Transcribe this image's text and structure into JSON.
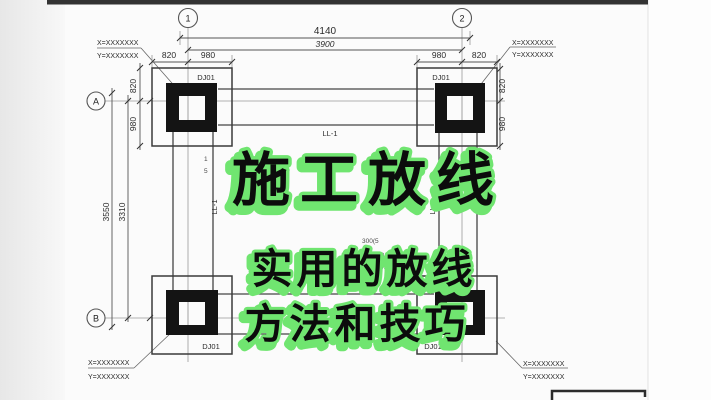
{
  "overlay": {
    "title": "施工放线",
    "subtitle_line1": "实用的放线",
    "subtitle_line2": "方法和技巧",
    "colors": {
      "ink": "#0c0c0c",
      "outline_green": "#70e570"
    }
  },
  "drawing": {
    "grid_labels": {
      "col_1": "1",
      "col_2": "2",
      "row_a": "A",
      "row_b": "B"
    },
    "dims": {
      "overall": "4140",
      "span": "3900",
      "d820": "820",
      "d980": "980",
      "v_overall": "3550",
      "v_span": "3310"
    },
    "pads": {
      "label": "DJ01"
    },
    "coords": {
      "x": "X=XXXXXXX",
      "y": "Y=XXXXXXX"
    },
    "beam_label": "LL-1",
    "notes": {
      "rebar": "G4Φ12",
      "frag_size": "300(5",
      "frag_at": "@",
      "frag_level": "0.(",
      "frag_1": "1",
      "frag_5": "5"
    }
  }
}
